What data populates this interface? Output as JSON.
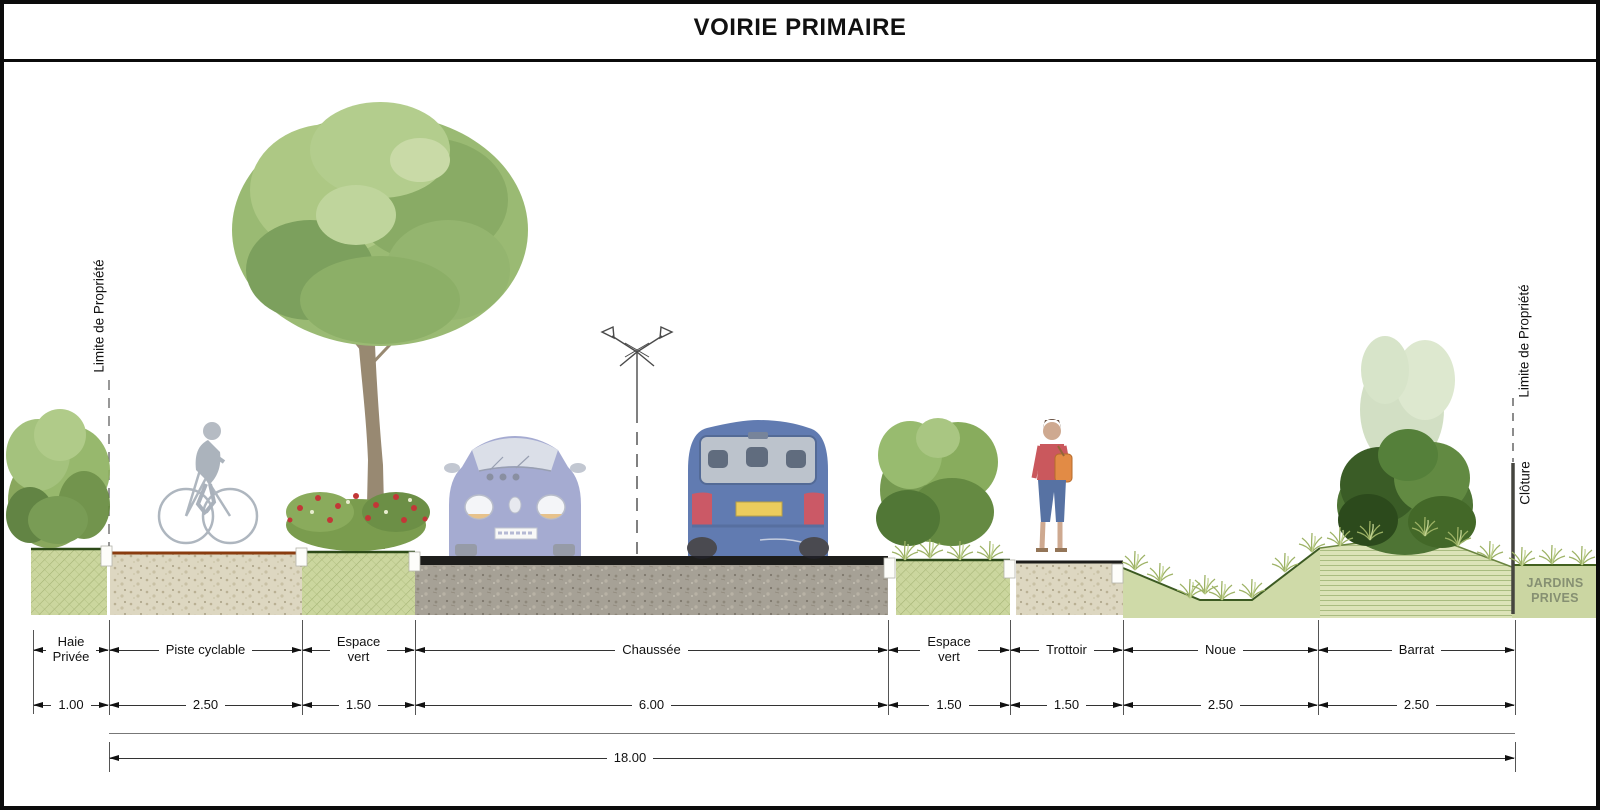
{
  "title": "VOIRIE PRIMAIRE",
  "annotations": {
    "property_limit_left": "Limite de Propriété",
    "property_limit_right": "Limite de Propriété",
    "fence": "Clôture",
    "private_gardens": "JARDINS\nPRIVES"
  },
  "dimensions": {
    "segments": [
      {
        "label": "Haie\nPrivée",
        "value": "1.00"
      },
      {
        "label": "Piste cyclable",
        "value": "2.50"
      },
      {
        "label": "Espace\nvert",
        "value": "1.50"
      },
      {
        "label": "Chaussée",
        "value": "6.00"
      },
      {
        "label": "Espace\nvert",
        "value": "1.50"
      },
      {
        "label": "Trottoir",
        "value": "1.50"
      },
      {
        "label": "Noue",
        "value": "2.50"
      },
      {
        "label": "Barrat",
        "value": "2.50"
      }
    ],
    "total": "18.00"
  },
  "figures": [
    "private-hedge",
    "cyclist",
    "tree",
    "flower-bed",
    "car-front",
    "street-lamp",
    "car-rear",
    "shrub",
    "pedestrian",
    "swale-grass",
    "berm-bush",
    "fence"
  ],
  "palette": {
    "grass_green": "#cbd69e",
    "asphalt": "#1d1d1b",
    "gravel_beige": "#ddd7c1",
    "gravel_grey": "#a6a196",
    "cycle_path_edge": "#8a3c10",
    "berm_green": "#dce3b8",
    "dark_green_edge": "#2d4a18",
    "text": "#111111"
  }
}
